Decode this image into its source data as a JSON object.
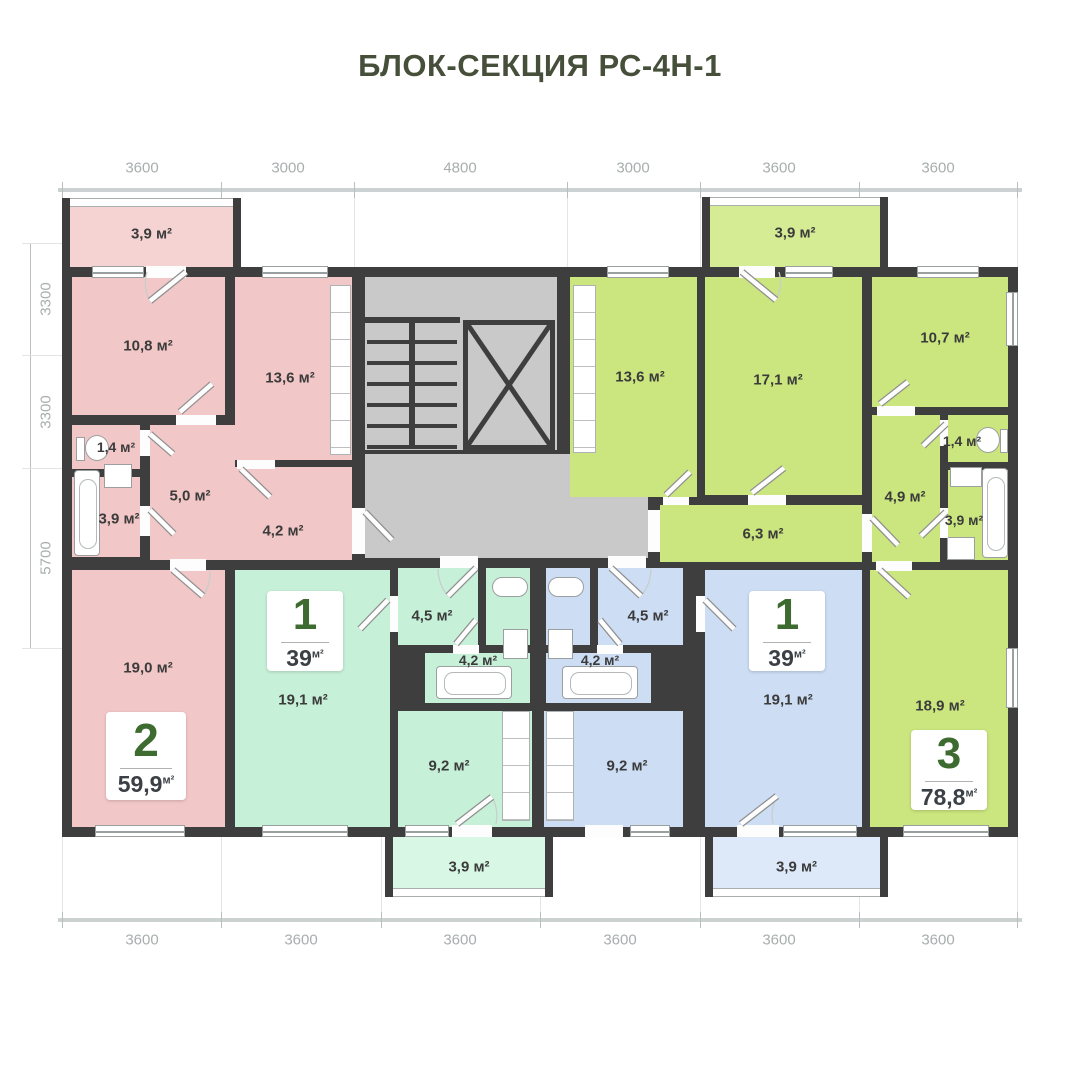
{
  "title": "БЛОК-СЕКЦИЯ РС-4Н-1",
  "colors": {
    "title_green": "#464f3a",
    "badge_green": "#3e6b2f",
    "wall": "#3e3e3e",
    "pink": "#f2c7c7",
    "mint": "#c7f0d8",
    "blue": "#cdddf4",
    "lime": "#cbe67e",
    "core_gray": "#c9c9c9",
    "dim_text": "#a8aeae"
  },
  "dimensions": {
    "top": [
      "3600",
      "3000",
      "4800",
      "3000",
      "3600",
      "3600"
    ],
    "bottom": [
      "3600",
      "3600",
      "3600",
      "3600",
      "3600",
      "3600"
    ],
    "left": [
      "3300",
      "3300",
      "5700"
    ]
  },
  "apartments": {
    "pink": {
      "number": "2",
      "area": "59,9",
      "unit": "м²"
    },
    "mint": {
      "number": "1",
      "area": "39",
      "unit": "м²"
    },
    "blue": {
      "number": "1",
      "area": "39",
      "unit": "м²"
    },
    "lime": {
      "number": "3",
      "area": "78,8",
      "unit": "м²"
    }
  },
  "rooms": {
    "pink_balcony": "3,9 м²",
    "pink_10_8": "10,8 м²",
    "pink_13_6": "13,6 м²",
    "pink_wc": "1,4 м²",
    "pink_bath": "3,9 м²",
    "pink_hall": "5,0 м²",
    "pink_corr": "4,2 м²",
    "pink_19_0": "19,0 м²",
    "mint_19_1": "19,1 м²",
    "mint_hall": "4,5 м²",
    "mint_bath": "4,2 м²",
    "mint_kitchen": "9,2 м²",
    "mint_balcony": "3,9 м²",
    "blue_19_1": "19,1 м²",
    "blue_hall": "4,5 м²",
    "blue_bath": "4,2 м²",
    "blue_kitchen": "9,2 м²",
    "blue_balcony": "3,9 м²",
    "lime_13_6": "13,6 м²",
    "lime_17_1": "17,1 м²",
    "lime_10_7": "10,7 м²",
    "lime_wc": "1,4 м²",
    "lime_bath": "3,9 м²",
    "lime_hall": "4,9 м²",
    "lime_corr": "6,3 м²",
    "lime_18_9": "18,9 м²",
    "lime_balcony": "3,9 м²"
  }
}
